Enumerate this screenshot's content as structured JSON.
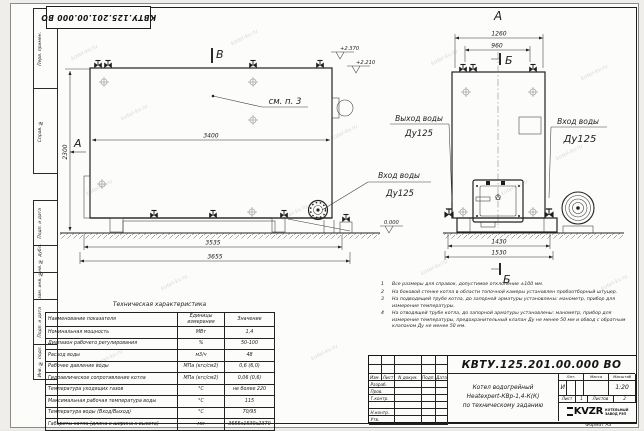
{
  "watermark": "kotel-kv.ru",
  "stamp_top": "КВТУ.125.201.00.000 ВО",
  "margin": [
    "Перв. примен.",
    "Справ. №",
    "Подп. и дата",
    "Инв. № дубл.",
    "Взам. инв. №",
    "Подп. и дата",
    "Инв. № подл."
  ],
  "side_view": {
    "label_a": "А",
    "label_v": "В",
    "callout": "см. п. 3",
    "dim_width": "3400",
    "dim_height": "2300",
    "dim_base": "3535",
    "dim_overall": "3655",
    "elev_top": "+2.370",
    "elev_mid": "+2.210",
    "elev_zero": "0.000",
    "inlet_title": "Вход воды",
    "inlet_dn": "Ду125"
  },
  "front_view": {
    "label_a": "А",
    "label_b_top": "Б",
    "label_b_bottom": "Б",
    "dim_top_outer": "1260",
    "dim_top_inner": "960",
    "dim_bottom_inner": "1430",
    "dim_bottom_outer": "1530",
    "outlet_title": "Выход воды",
    "outlet_dn": "Ду125",
    "inlet_title": "Вход воды",
    "inlet_dn": "Ду125"
  },
  "notes": [
    "Все размеры для справок, допустимое отклонение ±100 мм.",
    "На боковой стенке котла в области топочной камеры установлен пробоотборный штуцер.",
    "На подводящей трубе котла, до запорной арматуры установлены: манометр, прибор для измерения температуры.",
    "На отводящей трубе котла, до запорной арматуры установлены: манометр, прибор для измерения температуры, предохранительный клапан Ду не менее 50 мм и обвод с обратным клапаном Ду не менее 50 мм."
  ],
  "spec_table": {
    "title": "Техническая характеристика",
    "headers": [
      "Наименование показателя",
      "Единицы измерения",
      "Значение"
    ],
    "rows": [
      {
        "name": "Номинальная мощность",
        "unit": "МВт",
        "value": "1,4"
      },
      {
        "name": "Диапазон рабочего регулирования",
        "unit": "%",
        "value": "50-100"
      },
      {
        "name": "Расход воды",
        "unit": "м3/ч",
        "value": "48"
      },
      {
        "name": "Рабочее давление воды",
        "unit": "МПа (кгс/см2)",
        "value": "0,6 (6,0)"
      },
      {
        "name": "Гидравлическое сопротивление котла",
        "unit": "МПа (кгс/см2)",
        "value": "0,06 (0,6)"
      },
      {
        "name": "Температура уходящих газов",
        "unit": "°С",
        "value": "не более 220"
      },
      {
        "name": "Максимальная рабочая температура воды",
        "unit": "°С",
        "value": "115"
      },
      {
        "name": "Температура воды (Вход/Выход)",
        "unit": "°С",
        "value": "70/95"
      },
      {
        "name": "Габариты котла (длина х ширина х высота)",
        "unit": "мм",
        "value": "3655х1530х2370"
      }
    ]
  },
  "title_block": {
    "doc_number": "КВТУ.125.201.00.000  ВО",
    "header_cells": [
      "Изм.",
      "Лист",
      "N докум.",
      "Подп.",
      "Дата"
    ],
    "row_labels": [
      "Разраб.",
      "Пров.",
      "Т.контр.",
      "",
      "Н.контр.",
      "Утв."
    ],
    "product_lines": [
      "Котел водогрейный",
      "Heatexpert-КВр-1,4-К(К)",
      "по техническому заданию"
    ],
    "lit_label": "Лит.",
    "lit_value": "И",
    "mass_label": "Масса",
    "scale_label": "Масштаб",
    "scale_value": "1:20",
    "sheet_label": "Лист",
    "sheet_value": "1",
    "sheets_label": "Листов",
    "sheets_value": "2",
    "logo_text": "KVZR",
    "company_line1": "КОТЕЛЬНЫЙ",
    "company_line2": "ЗАВОД РЭП",
    "format_label": "Формат",
    "format_value": "А3"
  }
}
